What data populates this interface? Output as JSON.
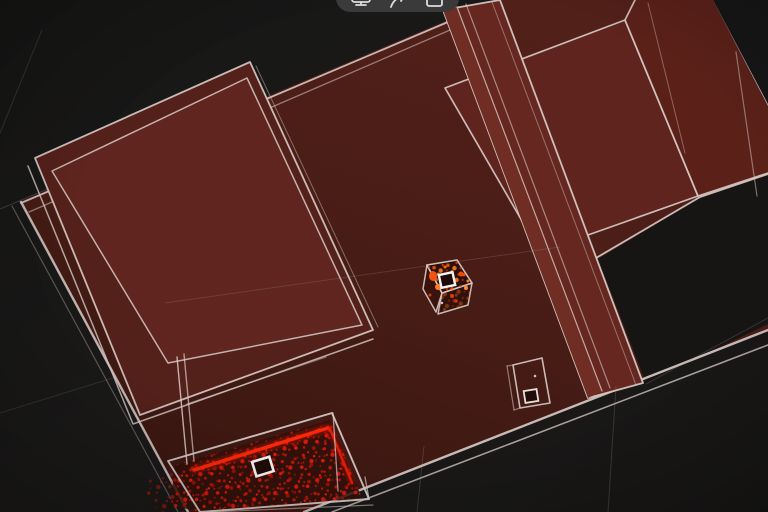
{
  "toolbar": {
    "icons": [
      {
        "name": "display-icon"
      },
      {
        "name": "share-arrow-icon"
      },
      {
        "name": "stop-square-icon"
      }
    ]
  },
  "theme": {
    "colors": {
      "bg": "#1a1918",
      "wire": "#d8cbc7",
      "pill": "#3a3a3b",
      "icon": "#dcdcdc",
      "floor": "#491d16",
      "accent-orange": "#f4560f",
      "point-red": "#d61707"
    }
  },
  "scene": {
    "view": "top-down-3d-room-scan",
    "objects": [
      {
        "name": "room-floor"
      },
      {
        "name": "large-box"
      },
      {
        "name": "counter-slab"
      },
      {
        "name": "right-box"
      },
      {
        "name": "far-right-box"
      },
      {
        "name": "scanned-cube",
        "has_marker": true
      },
      {
        "name": "small-box"
      },
      {
        "name": "scanned-surface",
        "has_marker": true
      }
    ],
    "markers": 2
  }
}
